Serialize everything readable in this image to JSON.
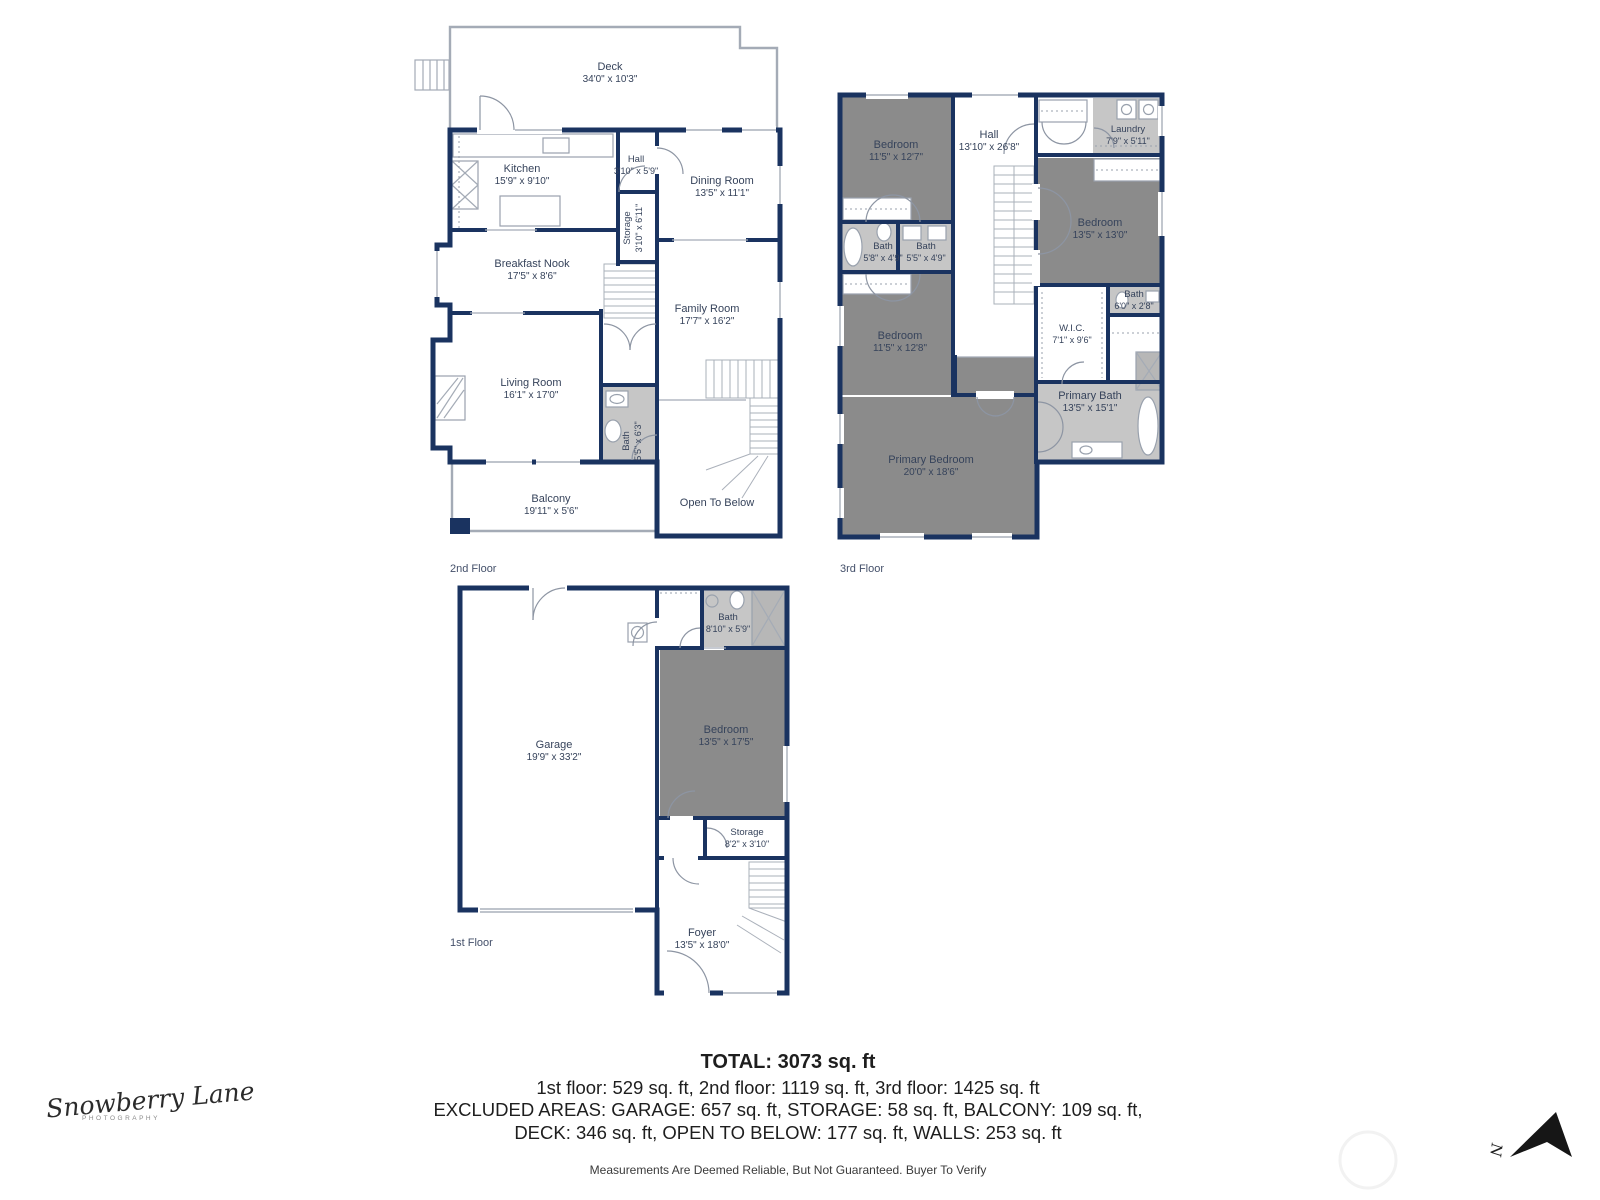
{
  "colors": {
    "wall": "#1a3360",
    "bed": "#8b8b8b",
    "bath": "#c6c6c6",
    "shower": "#b7b7b7",
    "line": "#a4abb6",
    "label": "#36435b"
  },
  "floors": [
    {
      "id": "f2",
      "label": "2nd Floor",
      "lx": 450,
      "ly": 572,
      "rooms": [
        {
          "name": "Deck",
          "dims": "34'0\" x 10'3\"",
          "cx": 610,
          "cy": 70
        },
        {
          "name": "Kitchen",
          "dims": "15'9\" x 9'10\"",
          "cx": 522,
          "cy": 172
        },
        {
          "name": "Hall",
          "dims": "3'10\" x 5'9\"",
          "cx": 636,
          "cy": 162,
          "fs": 1
        },
        {
          "name": "Dining Room",
          "dims": "13'5\" x 11'1\"",
          "cx": 722,
          "cy": 184
        },
        {
          "name": "Storage",
          "dims": "3'10\" x 6'11\"",
          "cx": 630,
          "cy": 228,
          "vertical": true,
          "fs": 1
        },
        {
          "name": "Breakfast Nook",
          "dims": "17'5\" x 8'6\"",
          "cx": 532,
          "cy": 267
        },
        {
          "name": "Family Room",
          "dims": "17'7\" x 16'2\"",
          "cx": 707,
          "cy": 312
        },
        {
          "name": "Living Room",
          "dims": "16'1\" x 17'0\"",
          "cx": 531,
          "cy": 386,
          "fill": "none"
        },
        {
          "name": "Bath",
          "dims": "5'5\" x 6'3\"",
          "cx": 629,
          "cy": 441,
          "vertical": true,
          "fs": 1,
          "rect": [
            603,
            387,
            54,
            73
          ],
          "fill": "bath"
        },
        {
          "name": "Balcony",
          "dims": "19'11\" x 5'6\"",
          "cx": 551,
          "cy": 502
        },
        {
          "name": "Open To Below",
          "cx": 717,
          "cy": 506
        }
      ]
    },
    {
      "id": "f3",
      "label": "3rd Floor",
      "lx": 840,
      "ly": 572,
      "rooms": [
        {
          "name": "Bedroom",
          "dims": "11'5\" x 12'7\"",
          "cx": 896,
          "cy": 148,
          "rect": [
            842,
            97,
            111,
            125
          ],
          "fill": "bed"
        },
        {
          "name": "Hall",
          "dims": "13'10\" x 26'8\"",
          "cx": 989,
          "cy": 138
        },
        {
          "name": "Laundry",
          "dims": "7'9\" x 5'11\"",
          "cx": 1128,
          "cy": 132,
          "fs": 1,
          "rect": [
            1093,
            98,
            69,
            57
          ],
          "fill": "bath"
        },
        {
          "name": "Bedroom",
          "dims": "13'5\" x 13'0\"",
          "cx": 1100,
          "cy": 226,
          "rect": [
            1038,
            158,
            124,
            127
          ],
          "fill": "bed"
        },
        {
          "name": "Bath",
          "dims": "5'8\" x 4'9\"",
          "cx": 883,
          "cy": 249,
          "fs": 1,
          "rect": [
            842,
            224,
            55,
            48
          ],
          "fill": "bath"
        },
        {
          "name": "Bath",
          "dims": "5'5\" x 4'9\"",
          "cx": 926,
          "cy": 249,
          "fs": 1,
          "rect": [
            899,
            224,
            54,
            48
          ],
          "fill": "bath"
        },
        {
          "name": "Bedroom",
          "dims": "11'5\" x 12'8\"",
          "cx": 900,
          "cy": 339,
          "rect": [
            842,
            274,
            111,
            121
          ],
          "fill": "bed"
        },
        {
          "name": "W.I.C.",
          "dims": "7'1\" x 9'6\"",
          "cx": 1072,
          "cy": 331,
          "fs": 1
        },
        {
          "name": "Bath",
          "dims": "6'0\" x 2'8\"",
          "cx": 1134,
          "cy": 297,
          "fs": 1,
          "rect": [
            1110,
            287,
            52,
            28
          ],
          "fill": "bath"
        },
        {
          "name": "Primary Bath",
          "dims": "13'5\" x 15'1\"",
          "cx": 1090,
          "cy": 399,
          "rect": [
            1038,
            384,
            124,
            76
          ],
          "fill": "bath"
        },
        {
          "name": "Primary Bedroom",
          "dims": "20'0\" x 18'6\"",
          "cx": 931,
          "cy": 463,
          "poly": "842,397 955,397 955,357 1035,357 1035,535 842,535",
          "fill": "bed"
        }
      ]
    },
    {
      "id": "f1",
      "label": "1st Floor",
      "lx": 450,
      "ly": 946,
      "rooms": [
        {
          "name": "Garage",
          "dims": "19'9\" x 33'2\"",
          "cx": 554,
          "cy": 748
        },
        {
          "name": "Bath",
          "dims": "8'10\" x 5'9\"",
          "cx": 728,
          "cy": 620,
          "fs": 1,
          "rect": [
            703,
            590,
            82,
            57
          ],
          "fill": "bath"
        },
        {
          "name": "Bedroom",
          "dims": "13'5\" x 17'5\"",
          "cx": 726,
          "cy": 733,
          "rect": [
            660,
            650,
            125,
            166
          ],
          "fill": "bed"
        },
        {
          "name": "Storage",
          "dims": "8'2\" x 3'10\"",
          "cx": 747,
          "cy": 835,
          "fs": 1
        },
        {
          "name": "Foyer",
          "dims": "13'5\" x 18'0\"",
          "cx": 702,
          "cy": 936
        }
      ]
    }
  ],
  "summary": {
    "total": "TOTAL: 3073 sq. ft",
    "line1": "1st floor: 529 sq. ft, 2nd floor: 1119 sq. ft, 3rd floor: 1425 sq. ft",
    "line2": "EXCLUDED AREAS: GARAGE: 657 sq. ft, STORAGE: 58 sq. ft, BALCONY: 109 sq. ft,",
    "line3": "DECK: 346 sq. ft, OPEN TO BELOW: 177 sq. ft, WALLS: 253 sq. ft",
    "disclaimer": "Measurements Are Deemed Reliable, But Not Guaranteed. Buyer To Verify"
  },
  "branding": {
    "logo_script": "Snowberry Lane",
    "logo_sub": "PHOTOGRAPHY"
  },
  "compass": {
    "label": "N"
  }
}
